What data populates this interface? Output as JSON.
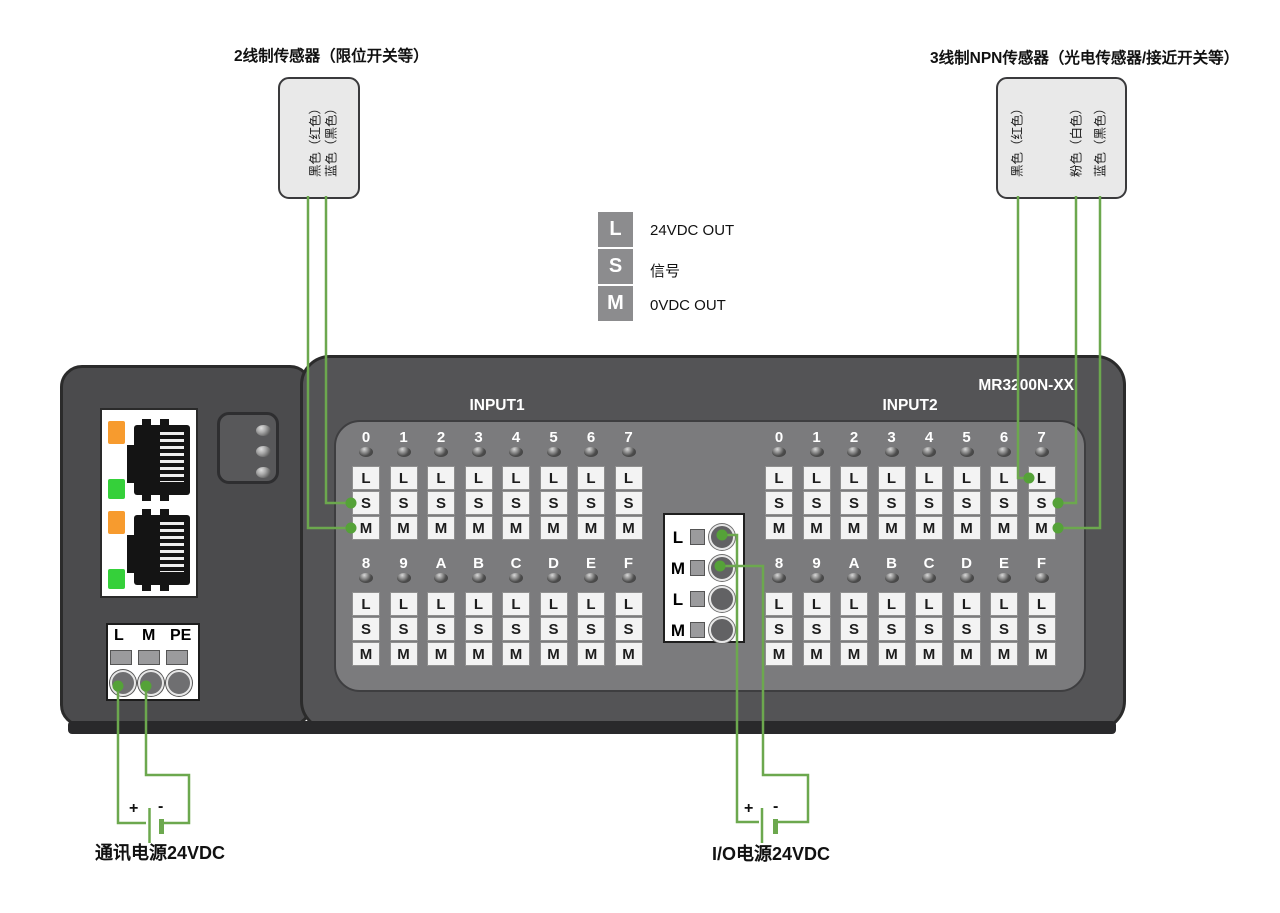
{
  "sensors": {
    "two_wire": {
      "title": "2线制传感器（限位开关等）",
      "wire_labels": [
        "黑色（红色）",
        "蓝色（黑色）"
      ]
    },
    "three_wire": {
      "title": "3线制NPN传感器（光电传感器/接近开关等）",
      "wire_labels": [
        "黑色（红色）",
        "粉色（白色）",
        "蓝色（黑色）"
      ]
    }
  },
  "legend": {
    "items": [
      {
        "key": "L",
        "desc": "24VDC OUT"
      },
      {
        "key": "S",
        "desc": "信号"
      },
      {
        "key": "M",
        "desc": "0VDC OUT"
      }
    ]
  },
  "device": {
    "model": "MR3200N-XX",
    "terminal_letters": [
      "L",
      "S",
      "M"
    ],
    "inputs": [
      {
        "name": "INPUT1",
        "channel_rows": [
          [
            "0",
            "1",
            "2",
            "3",
            "4",
            "5",
            "6",
            "7"
          ],
          [
            "8",
            "9",
            "A",
            "B",
            "C",
            "D",
            "E",
            "F"
          ]
        ]
      },
      {
        "name": "INPUT2",
        "channel_rows": [
          [
            "0",
            "1",
            "2",
            "3",
            "4",
            "5",
            "6",
            "7"
          ],
          [
            "8",
            "9",
            "A",
            "B",
            "C",
            "D",
            "E",
            "F"
          ]
        ]
      }
    ],
    "comm_terminal_labels": [
      "L",
      "M",
      "PE"
    ],
    "io_terminal_labels": [
      "L",
      "M",
      "L",
      "M"
    ]
  },
  "power": {
    "comm": {
      "plus": "+",
      "minus": "-",
      "label": "通讯电源24VDC"
    },
    "io": {
      "plus": "+",
      "minus": "-",
      "label": "I/O电源24VDC"
    }
  },
  "colors": {
    "wire_green": "#6CA84E",
    "dot_green": "#55A238",
    "device_body": "#4E4E50",
    "device_body_light": "#545456",
    "inner_panel": "#7B7B7D",
    "terminal_box": "#F3F3F3",
    "led_orange": "#F79B2E",
    "led_green": "#35D03A",
    "legend_box": "#8C8C8E"
  }
}
